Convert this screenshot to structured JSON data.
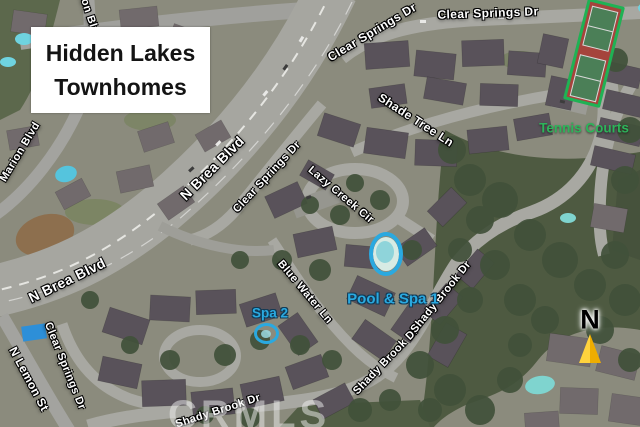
{
  "map_title": {
    "line1": "Hidden Lakes",
    "line2": "Townhomes"
  },
  "street_labels": [
    {
      "text": "Marion Blvd",
      "x": 87,
      "y": 8,
      "rotate": 72,
      "size": 11
    },
    {
      "text": "Marion Blvd",
      "x": 20,
      "y": 152,
      "rotate": -59,
      "size": 11
    },
    {
      "text": "N Brea Blvd",
      "x": 212,
      "y": 168,
      "rotate": -45,
      "size": 14
    },
    {
      "text": "Clear Springs Dr",
      "x": 267,
      "y": 177,
      "rotate": -47,
      "size": 11
    },
    {
      "text": "Clear Springs Dr",
      "x": 372,
      "y": 32,
      "rotate": -31,
      "size": 12
    },
    {
      "text": "Clear Springs Dr",
      "x": 488,
      "y": 13,
      "rotate": -2,
      "size": 12
    },
    {
      "text": "Shade Tree Ln",
      "x": 416,
      "y": 120,
      "rotate": 33,
      "size": 12
    },
    {
      "text": "Lazy Creek Cir",
      "x": 341,
      "y": 195,
      "rotate": 40,
      "size": 11
    },
    {
      "text": "Blue Water Ln",
      "x": 305,
      "y": 292,
      "rotate": 50,
      "size": 11
    },
    {
      "text": "N Brea Blvd",
      "x": 67,
      "y": 280,
      "rotate": -26,
      "size": 14
    },
    {
      "text": "Clear Springs Dr",
      "x": 65,
      "y": 366,
      "rotate": 68,
      "size": 11
    },
    {
      "text": "N Lemon St",
      "x": 29,
      "y": 379,
      "rotate": 62,
      "size": 12
    },
    {
      "text": "Shady Brook Dr",
      "x": 218,
      "y": 411,
      "rotate": -18,
      "size": 11
    },
    {
      "text": "Shady Brook Dr",
      "x": 386,
      "y": 361,
      "rotate": -46,
      "size": 11
    },
    {
      "text": "Shady Brook Dr",
      "x": 441,
      "y": 297,
      "rotate": -51,
      "size": 11
    }
  ],
  "annotations": {
    "tennis_courts": {
      "label": "Tennis Courts",
      "color": "#2db45a",
      "outline_color": "#1fb254"
    },
    "pool_spa_1": {
      "label": "Pool & Spa 1",
      "color": "#2aa9e0"
    },
    "spa_2": {
      "label": "Spa 2",
      "color": "#2aa9e0"
    },
    "compass": {
      "label": "N",
      "arrow_color": "#ffc608"
    },
    "watermark": {
      "text": "CRMLS"
    }
  }
}
